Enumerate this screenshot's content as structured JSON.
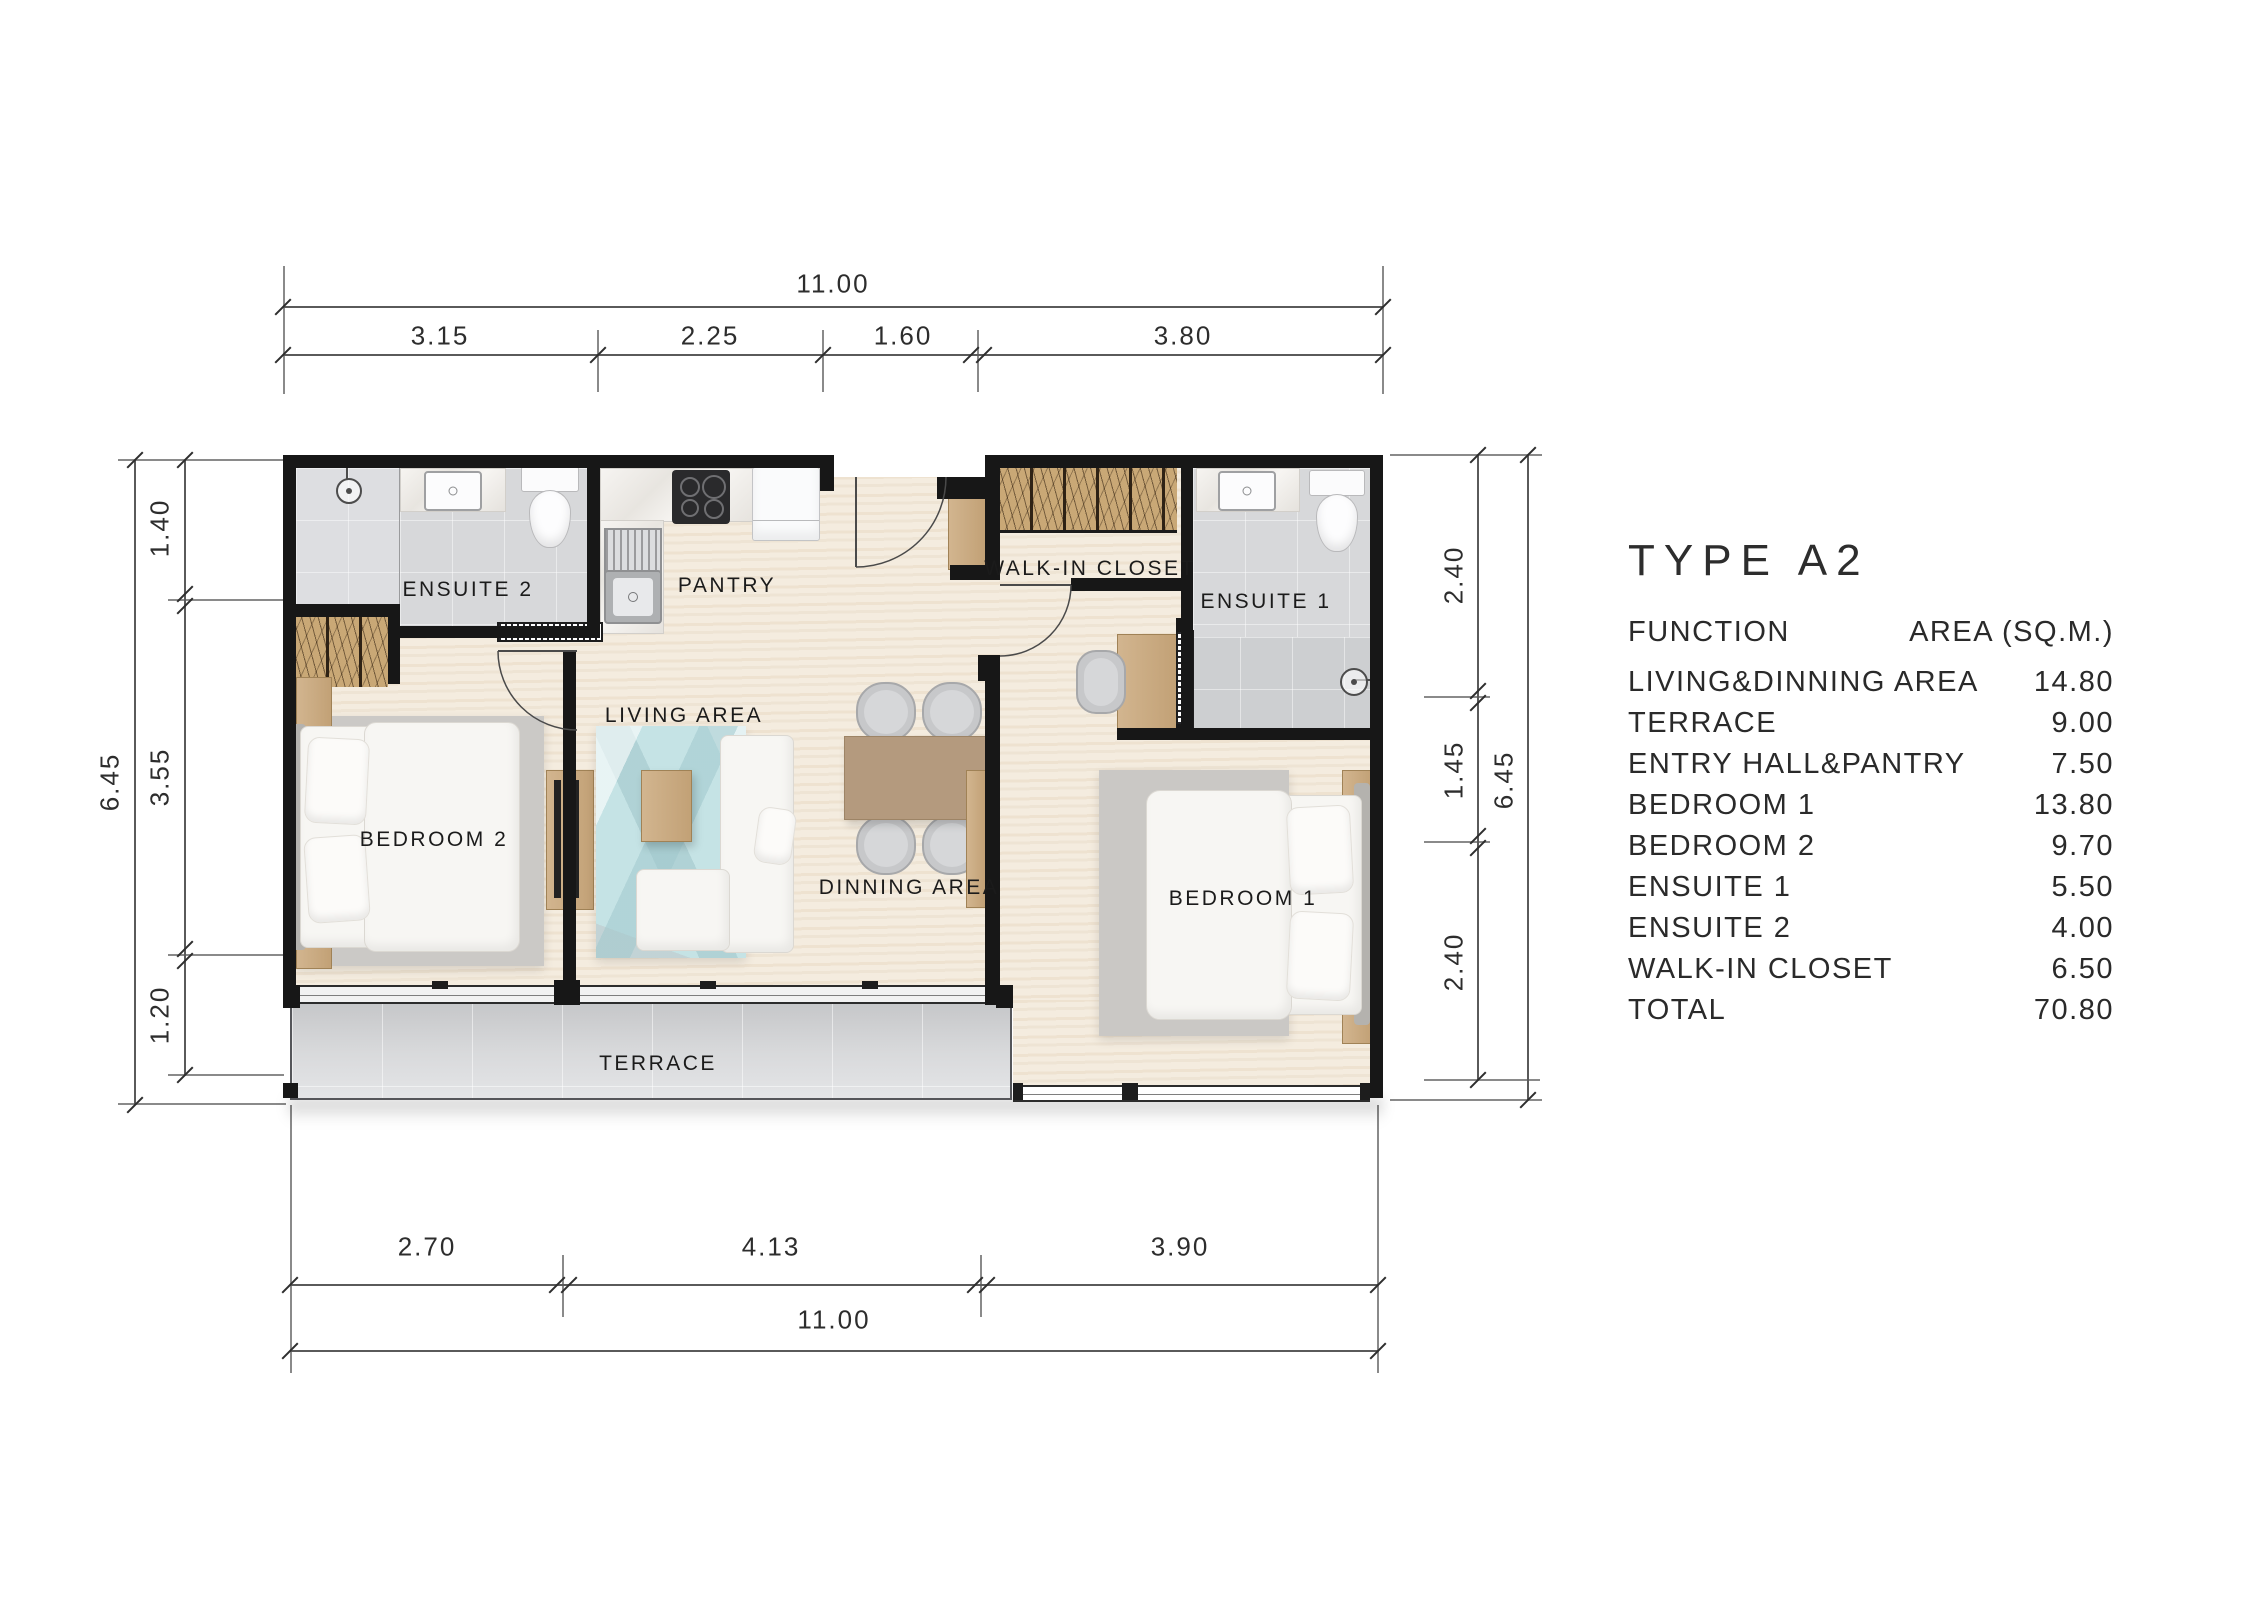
{
  "plan": {
    "rooms": {
      "ensuite2": "ENSUITE 2",
      "pantry": "PANTRY",
      "walk_in_closet": "WALK-IN CLOSET",
      "ensuite1": "ENSUITE 1",
      "living": "LIVING AREA",
      "dinning": "DINNING AREA",
      "bedroom2": "BEDROOM 2",
      "bedroom1": "BEDROOM 1",
      "terrace": "TERRACE"
    }
  },
  "dimensions": {
    "top": {
      "overall": "11.00",
      "segments": [
        "3.15",
        "2.25",
        "1.60",
        "3.80"
      ]
    },
    "bottom": {
      "overall": "11.00",
      "segments": [
        "2.70",
        "4.13",
        "3.90"
      ]
    },
    "left": {
      "overall": "6.45",
      "segments": [
        "1.40",
        "3.55",
        "1.20"
      ]
    },
    "right": {
      "overall": "6.45",
      "segments": [
        "2.40",
        "1.45",
        "2.40"
      ]
    }
  },
  "area_table": {
    "title": "TYPE A2",
    "header": {
      "function": "FUNCTION",
      "area": "AREA (SQ.M.)"
    },
    "rows": [
      {
        "function": "LIVING&DINNING AREA",
        "area": "14.80"
      },
      {
        "function": "TERRACE",
        "area": "9.00"
      },
      {
        "function": "ENTRY HALL&PANTRY",
        "area": "7.50"
      },
      {
        "function": "BEDROOM 1",
        "area": "13.80"
      },
      {
        "function": "BEDROOM 2",
        "area": "9.70"
      },
      {
        "function": "ENSUITE 1",
        "area": "5.50"
      },
      {
        "function": "ENSUITE 2",
        "area": "4.00"
      },
      {
        "function": "WALK-IN CLOSET",
        "area": "6.50"
      },
      {
        "function": "TOTAL",
        "area": "70.80"
      }
    ]
  },
  "colors": {
    "wall": "#171717",
    "wood_floor": "#f4ecdf",
    "bath_tile": "#d7d8da",
    "terrace_floor": "#d2d3d5",
    "wardrobe_wood": "#c9a876",
    "living_rug": "#c5e3e5",
    "dining_table": "#b49a7e",
    "dimension_text": "#2d2d2d"
  }
}
